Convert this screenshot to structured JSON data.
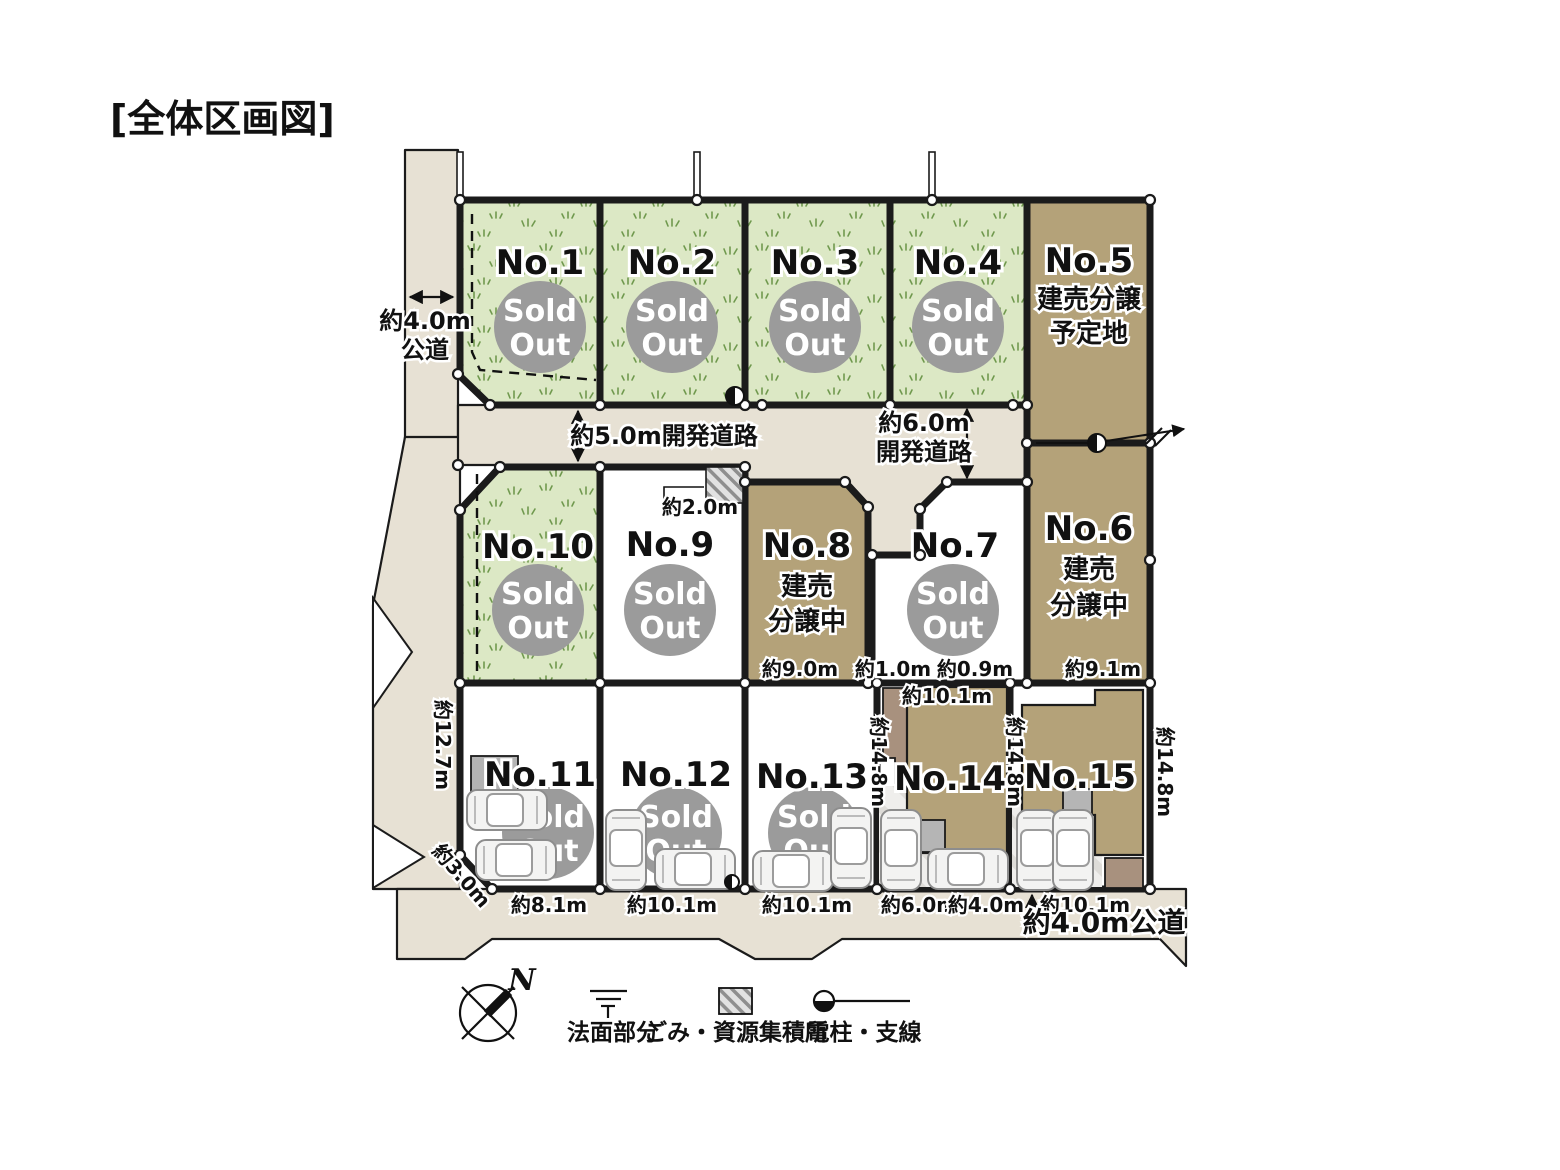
{
  "title": "[全体区画図]",
  "lots": {
    "no1": {
      "name": "No.1"
    },
    "no2": {
      "name": "No.2"
    },
    "no3": {
      "name": "No.3"
    },
    "no4": {
      "name": "No.4"
    },
    "no5": {
      "name": "No.5",
      "note1": "建売分譲",
      "note2": "予定地"
    },
    "no6": {
      "name": "No.6",
      "note1": "建売",
      "note2": "分譲中"
    },
    "no7": {
      "name": "No.7"
    },
    "no8": {
      "name": "No.8",
      "note1": "建売",
      "note2": "分譲中"
    },
    "no9": {
      "name": "No.9"
    },
    "no10": {
      "name": "No.10"
    },
    "no11": {
      "name": "No.11"
    },
    "no12": {
      "name": "No.12"
    },
    "no13": {
      "name": "No.13"
    },
    "no14": {
      "name": "No.14"
    },
    "no15": {
      "name": "No.15"
    }
  },
  "badge": {
    "line1": "Sold",
    "line2": "Out"
  },
  "roads": {
    "west_line1": "約4.0m",
    "west_line2": "公道",
    "dev5": "約5.0m開発道路",
    "dev6_line1": "約6.0m",
    "dev6_line2": "開発道路",
    "south": "約4.0m公道"
  },
  "dims": {
    "garbage_width": "約2.0m",
    "no8_bottom": "約9.0m",
    "gap1": "約1.0m",
    "gap2": "約0.9m",
    "no6_bottom": "約9.1m",
    "no14_top": "約10.1m",
    "no11_left": "約12.7m",
    "no11_corner": "約3.0m",
    "no11_bottom": "約8.1m",
    "no12_bottom": "約10.1m",
    "no13_bottom": "約10.1m",
    "no14_bottom_w": "約6.0m",
    "no14_bottom_e": "約4.0m",
    "no15_bottom": "約10.1m",
    "no14_left": "約14.8m",
    "no15_left": "約14.8m",
    "no15_right": "約14.8m"
  },
  "legend": {
    "north": "N",
    "slope": "法面部分",
    "garbage": "ごみ・資源集積所",
    "pole": "電柱・支線"
  },
  "colors": {
    "grass_green": "#dce8c5",
    "lot_brown": "#b4a279",
    "road_beige": "#e7e1d4",
    "sold_gray": "#9b9b9b",
    "building_annex": "#a8917e"
  }
}
